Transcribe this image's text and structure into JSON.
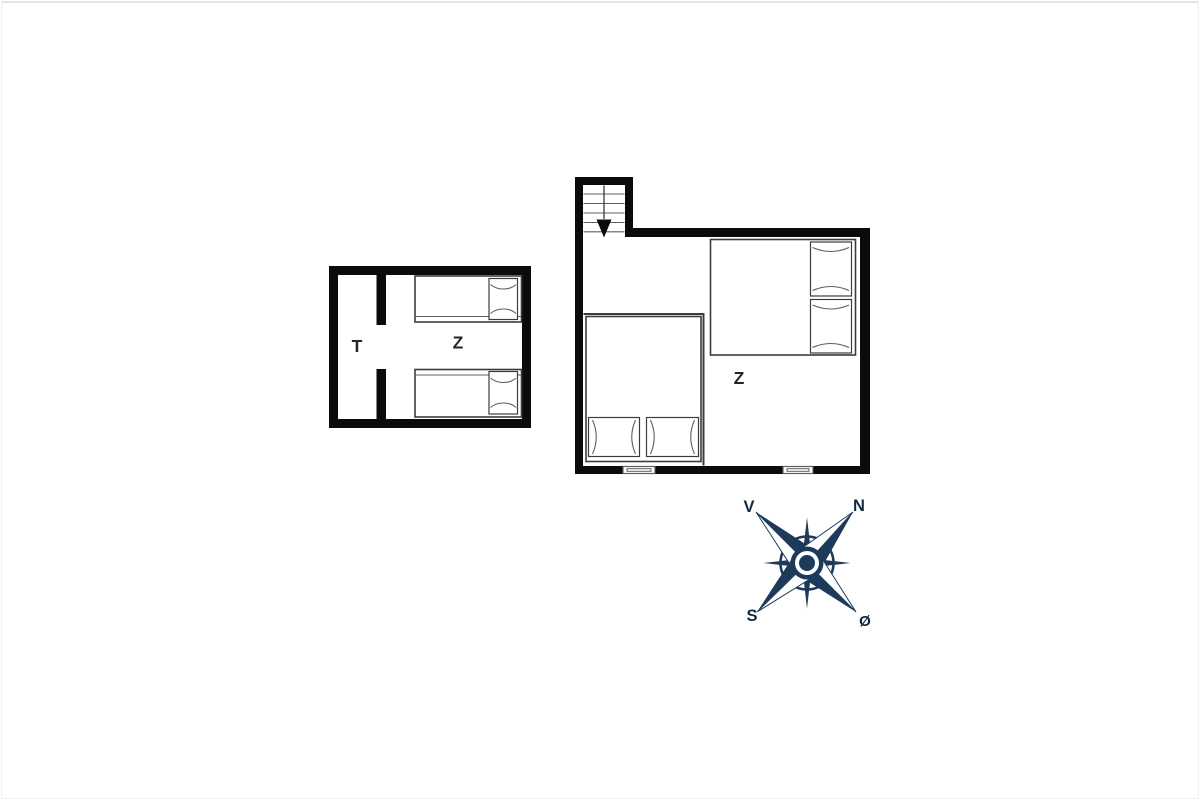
{
  "colors": {
    "wall": "#0b0b0b",
    "outline": "#3c3c3c",
    "detail": "#5f5f5f",
    "room_label": "#262626",
    "compass_navy": "#1e3a5a",
    "compass_text": "#15293e"
  },
  "annex": {
    "room_t_label": "T",
    "room_z_label": "Z"
  },
  "main_house": {
    "room_z_label": "Z"
  },
  "compass": {
    "west": "V",
    "north": "N",
    "south": "S",
    "east": "Ø"
  }
}
